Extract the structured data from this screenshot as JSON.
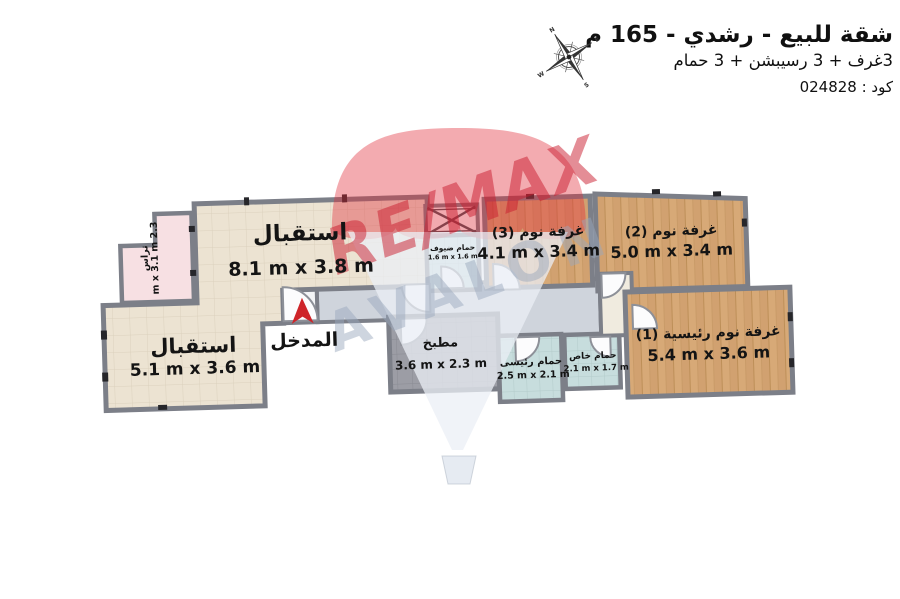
{
  "header": {
    "title": "شقة للبيع - رشدي - 165 م",
    "subtitle": "3غرف + 3 رسيبشن + 3 حمام",
    "code": "كود : 024828"
  },
  "compass": {
    "n": "N",
    "e": "E",
    "s": "S",
    "w": "W"
  },
  "watermark": {
    "brand": "RE/MAX",
    "office": "AVALON",
    "brand_color": "#c91c2d",
    "balloon_red": "#e02d3a"
  },
  "rooms": {
    "reception_top": {
      "name": "استقبال",
      "dims": "8.1 m x 3.8 m"
    },
    "reception_left": {
      "name": "استقبال",
      "dims": "5.1 m x 3.6 m"
    },
    "terrace": {
      "name": "تراس",
      "dims": "2.3 m x 3.1 m"
    },
    "entrance": {
      "name": "المدخل"
    },
    "kitchen": {
      "name": "مطبخ",
      "dims": "3.6 m x 2.3 m"
    },
    "guest_bath": {
      "name": "حمام ضيوف",
      "dims": "1.6 m x 1.6 m"
    },
    "bedroom3": {
      "name": "غرفة نوم (3)",
      "dims": "4.1 m x 3.4 m"
    },
    "bedroom2": {
      "name": "غرفة نوم (2)",
      "dims": "5.0 m x 3.4 m"
    },
    "master_bedroom": {
      "name": "غرفة نوم رئيسية (1)",
      "dims": "5.4 m x 3.6 m"
    },
    "main_bath": {
      "name": "حمام رئيسى",
      "dims": "2.5 m x 2.1 m"
    },
    "private_bath": {
      "name": "حمام خاص",
      "dims": "2.1 m x 1.7 m"
    }
  },
  "colors": {
    "wall": "#7c7f88",
    "tile_floor": "#ece3d2",
    "wood_floor": "#d7a977",
    "kitchen_floor": "#9c9da5",
    "bath_floor": "#c7dddd",
    "terrace_floor": "#f7e0e3",
    "hallway_floor": "#cfd4dc",
    "entrance_arrow": "#ce2429"
  }
}
